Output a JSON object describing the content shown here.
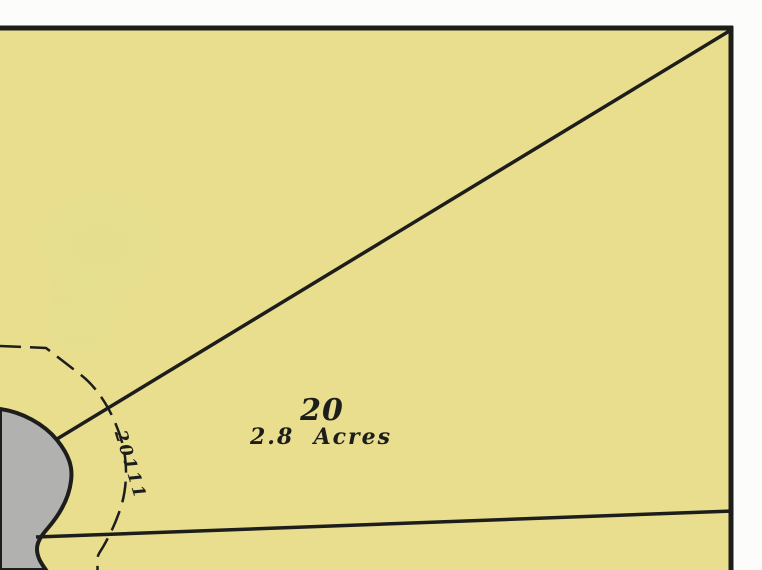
{
  "map": {
    "type": "plat-parcel-map",
    "labels": {
      "lot_number": "20",
      "lot_area": "2.8  Acres",
      "street_number": "20111"
    },
    "colors": {
      "parcel_fill": "#e9de8e",
      "road_fill": "#b1b1af",
      "line_ink": "#1d1d1b",
      "margin_paper": "#fcfcfb",
      "scan_blotch": "#dde093"
    }
  }
}
